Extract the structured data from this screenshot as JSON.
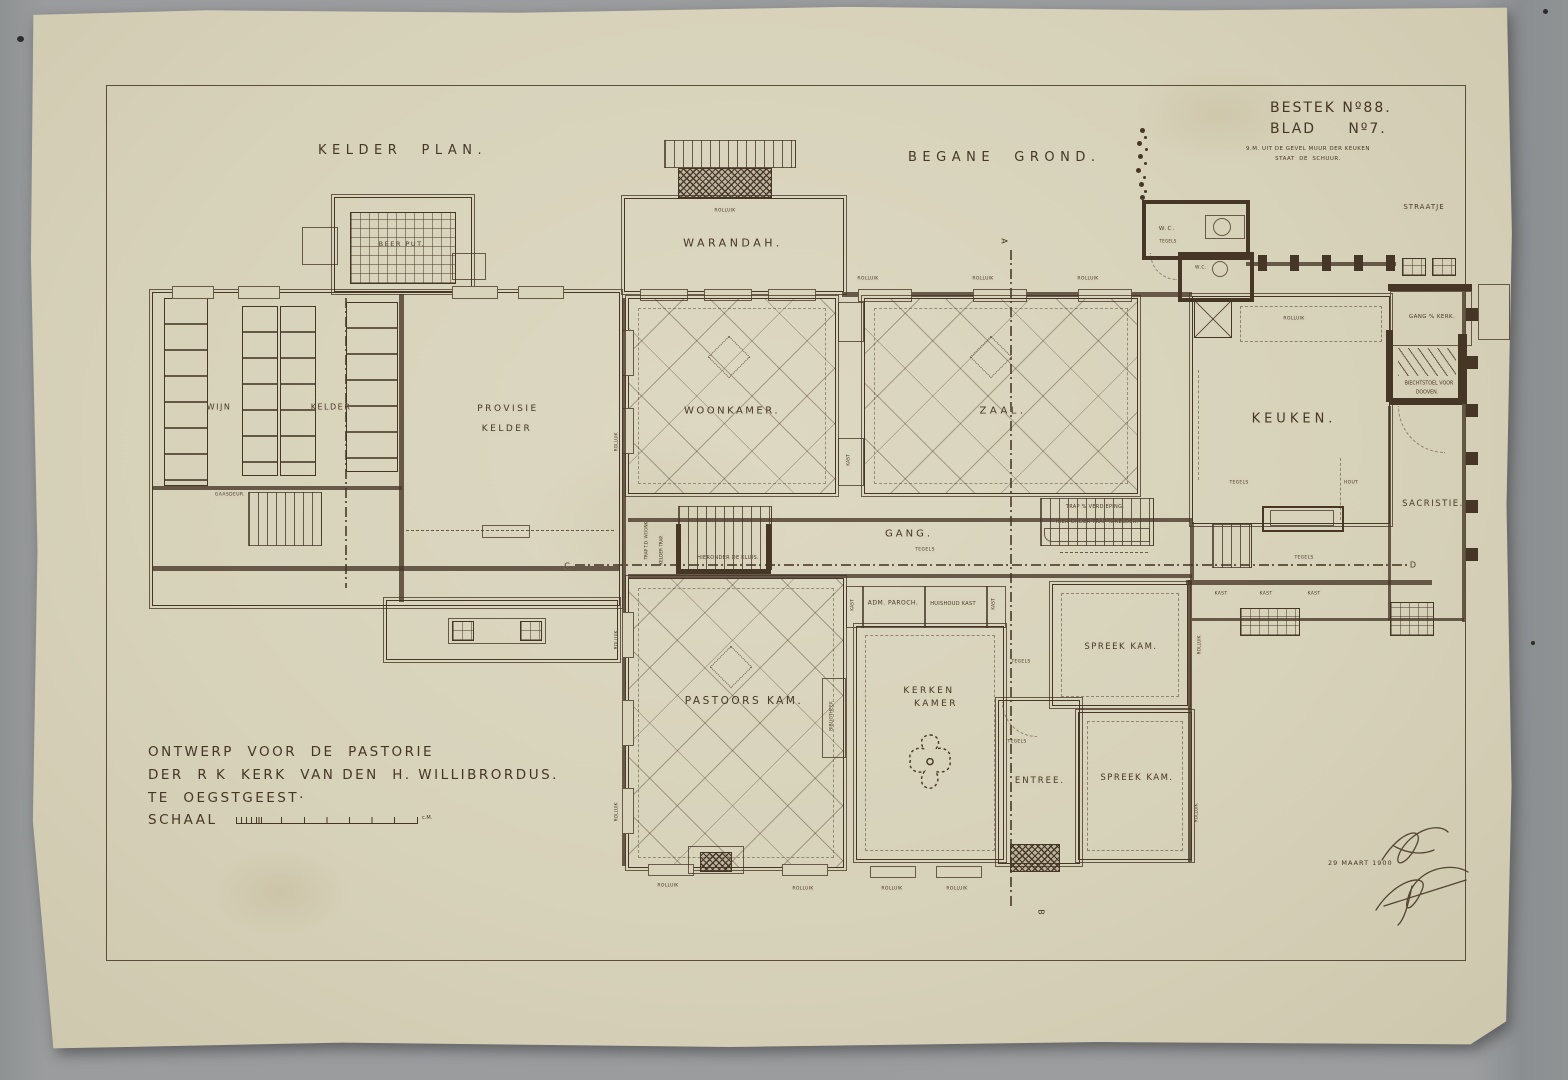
{
  "titles": {
    "kelder_plan": "KELDER  PLAN.",
    "begane_grond": "BEGANE  GROND.",
    "bestek": "BESTEK Nº88.",
    "blad": "BLAD     Nº7.",
    "note1": "9.M. UIT DE GEVEL MUUR DER KEUKEN",
    "note2": "STAAT  DE  SCHUUR."
  },
  "title_block": {
    "line1": "ONTWERP  VOOR  DE  PASTORIE",
    "line2": "DER  R K  KERK  VAN DEN  H. WILLIBRORDUS.",
    "line3": "TE  OEGSTGEEST·",
    "scale_label": "SCHAAL",
    "scale_unit": "c.M.",
    "date": "29 MAART 1900"
  },
  "labels": [
    {
      "t": "BEER PUT.",
      "x": 402,
      "y": 244,
      "fs": 6.5,
      "ls": 1.5,
      "n": "room-label-beerput"
    },
    {
      "t": "WIJN",
      "x": 219,
      "y": 407,
      "fs": 8,
      "ls": 1.5,
      "n": "room-label-wijn"
    },
    {
      "t": "KELDER",
      "x": 331,
      "y": 407,
      "fs": 8,
      "ls": 1.5,
      "n": "room-label-wijnkelder"
    },
    {
      "t": "PROVISIE",
      "x": 508,
      "y": 409,
      "fs": 9,
      "ls": 2.5,
      "n": "room-label-provisie"
    },
    {
      "t": "KELDER",
      "x": 507,
      "y": 429,
      "fs": 9,
      "ls": 2.5,
      "n": "room-label-provisie-kelder"
    },
    {
      "t": "GAASDEUR.",
      "x": 230,
      "y": 495,
      "fs": 4.5,
      "ls": 0.4,
      "n": "annotation"
    },
    {
      "t": "WARANDAH.",
      "x": 733,
      "y": 243,
      "fs": 11,
      "ls": 3.5,
      "n": "room-label-warandah"
    },
    {
      "t": "WOONKAMER.",
      "x": 732,
      "y": 411,
      "fs": 10,
      "ls": 2.5,
      "n": "room-label-woonkamer"
    },
    {
      "t": "ZAAL.",
      "x": 1003,
      "y": 411,
      "fs": 10,
      "ls": 3.5,
      "n": "room-label-zaal"
    },
    {
      "t": "KEUKEN.",
      "x": 1294,
      "y": 419,
      "fs": 13,
      "ls": 4,
      "n": "room-label-keuken"
    },
    {
      "t": "GANG.",
      "x": 909,
      "y": 534,
      "fs": 10,
      "ls": 3,
      "n": "room-label-gang"
    },
    {
      "t": "TEGELS",
      "x": 925,
      "y": 550,
      "fs": 4.5,
      "ls": 0.4,
      "n": "annotation"
    },
    {
      "t": "PASTOORS KAM.",
      "x": 744,
      "y": 701,
      "fs": 10.5,
      "ls": 2.5,
      "n": "room-label-pastoors-kamer"
    },
    {
      "t": "KERKEN",
      "x": 929,
      "y": 691,
      "fs": 9,
      "ls": 2.5,
      "n": "room-label-kerken"
    },
    {
      "t": "KAMER",
      "x": 936,
      "y": 704,
      "fs": 9,
      "ls": 2.5,
      "n": "room-label-kerken-kamer"
    },
    {
      "t": "SPREEK KAM.",
      "x": 1121,
      "y": 647,
      "fs": 8.5,
      "ls": 1.5,
      "n": "room-label-spreekkamer-1"
    },
    {
      "t": "SPREEK KAM.",
      "x": 1137,
      "y": 778,
      "fs": 8.5,
      "ls": 1.5,
      "n": "room-label-spreekkamer-2"
    },
    {
      "t": "ENTREE.",
      "x": 1040,
      "y": 781,
      "fs": 8.5,
      "ls": 2,
      "n": "room-label-entree"
    },
    {
      "t": "SACRISTIE.",
      "x": 1433,
      "y": 504,
      "fs": 8.5,
      "ls": 1.5,
      "n": "room-label-sacristie"
    },
    {
      "t": "STRAATJE",
      "x": 1424,
      "y": 207,
      "fs": 7,
      "ls": 1,
      "n": "room-label-straatje"
    },
    {
      "t": "GANG % KERK.",
      "x": 1432,
      "y": 317,
      "fs": 5.5,
      "ls": 0.4,
      "n": "room-label-gang-kerk"
    },
    {
      "t": "BIECHTSTOEL VOOR",
      "x": 1429,
      "y": 384,
      "fs": 4.8,
      "ls": 0,
      "n": "room-label-biechtstoel"
    },
    {
      "t": "DOOVEN.",
      "x": 1427,
      "y": 393,
      "fs": 4.8,
      "ls": 0,
      "n": "room-label-dooven"
    },
    {
      "t": "W.C.",
      "x": 1167,
      "y": 229,
      "fs": 5.5,
      "ls": 1,
      "n": "room-label-wc-1"
    },
    {
      "t": "TEGELS",
      "x": 1168,
      "y": 241,
      "fs": 4,
      "ls": 0.3,
      "n": "annotation"
    },
    {
      "t": "W.C.",
      "x": 1201,
      "y": 268,
      "fs": 4.5,
      "ls": 0.5,
      "n": "room-label-wc-2"
    },
    {
      "t": "ADM. PAROCH.",
      "x": 893,
      "y": 603,
      "fs": 6,
      "ls": 0.5,
      "n": "cabinet-label"
    },
    {
      "t": "HUISHOUD KAST",
      "x": 953,
      "y": 604,
      "fs": 5,
      "ls": 0.3,
      "n": "cabinet-label"
    },
    {
      "t": "KAST",
      "x": 853,
      "y": 605,
      "fs": 4.5,
      "v": true,
      "n": "cabinet-label"
    },
    {
      "t": "KAST",
      "x": 994,
      "y": 604,
      "fs": 4.5,
      "v": true,
      "n": "cabinet-label"
    },
    {
      "t": "KAST",
      "x": 849,
      "y": 460,
      "fs": 4.5,
      "v": true,
      "n": "cabinet-label"
    },
    {
      "t": "BIBLIOTHEEK",
      "x": 832,
      "y": 716,
      "fs": 4.5,
      "v": true,
      "n": "cabinet-label"
    },
    {
      "t": "TRAP % VERDIEPING.",
      "x": 1095,
      "y": 507,
      "fs": 5,
      "ls": 0.3,
      "n": "stairs-label"
    },
    {
      "t": "HIER ONDER TRAP % KELDER.",
      "x": 1097,
      "y": 522,
      "fs": 5,
      "ls": 0.3,
      "n": "stairs-label"
    },
    {
      "t": "HIERONDER DE KLUIS.",
      "x": 728,
      "y": 558,
      "fs": 5,
      "ls": 0.3,
      "n": "stairs-label"
    },
    {
      "t": "TRAP T.D. WOONK.",
      "x": 646,
      "y": 540,
      "fs": 4.2,
      "v": true,
      "n": "stairs-label"
    },
    {
      "t": "KELDER TRAP.",
      "x": 661,
      "y": 550,
      "fs": 4.2,
      "v": true,
      "n": "stairs-label"
    },
    {
      "t": "ROLLUIK",
      "x": 725,
      "y": 211,
      "fs": 4.5,
      "ls": 0.3,
      "n": "annotation"
    },
    {
      "t": "ROLLUIK",
      "x": 868,
      "y": 279,
      "fs": 4.5,
      "ls": 0.3,
      "n": "annotation"
    },
    {
      "t": "ROLLUIK",
      "x": 983,
      "y": 279,
      "fs": 4.5,
      "ls": 0.3,
      "n": "annotation"
    },
    {
      "t": "ROLLUIK",
      "x": 1088,
      "y": 279,
      "fs": 4.5,
      "ls": 0.3,
      "n": "annotation"
    },
    {
      "t": "ROLLUIK",
      "x": 1294,
      "y": 319,
      "fs": 4.5,
      "ls": 0.3,
      "n": "annotation"
    },
    {
      "t": "ROLLUIK",
      "x": 617,
      "y": 442,
      "fs": 4.5,
      "v": true,
      "n": "annotation"
    },
    {
      "t": "ROLLUIK",
      "x": 617,
      "y": 640,
      "fs": 4.5,
      "v": true,
      "n": "annotation"
    },
    {
      "t": "ROLLUIK",
      "x": 617,
      "y": 812,
      "fs": 4.5,
      "v": true,
      "n": "annotation"
    },
    {
      "t": "ROLLUIK",
      "x": 1200,
      "y": 645,
      "fs": 4.5,
      "v": true,
      "n": "annotation"
    },
    {
      "t": "ROLLUIK",
      "x": 1197,
      "y": 813,
      "fs": 4.5,
      "v": true,
      "n": "annotation"
    },
    {
      "t": "ROLLUIK",
      "x": 668,
      "y": 886,
      "fs": 4.5,
      "ls": 0.3,
      "n": "annotation"
    },
    {
      "t": "ROLLUIK",
      "x": 803,
      "y": 889,
      "fs": 4.5,
      "ls": 0.3,
      "n": "annotation"
    },
    {
      "t": "ROLLUIK",
      "x": 892,
      "y": 889,
      "fs": 4.5,
      "ls": 0.3,
      "n": "annotation"
    },
    {
      "t": "ROLLUIK",
      "x": 957,
      "y": 889,
      "fs": 4.5,
      "ls": 0.3,
      "n": "annotation"
    },
    {
      "t": "TEGELS",
      "x": 1021,
      "y": 662,
      "fs": 4.5,
      "ls": 0.3,
      "n": "annotation"
    },
    {
      "t": "TEGELS",
      "x": 1017,
      "y": 742,
      "fs": 4.5,
      "ls": 0.3,
      "n": "annotation"
    },
    {
      "t": "TEGELS",
      "x": 1239,
      "y": 483,
      "fs": 4.5,
      "ls": 0.3,
      "n": "annotation"
    },
    {
      "t": "TEGELS",
      "x": 1304,
      "y": 558,
      "fs": 4.5,
      "ls": 0.3,
      "n": "annotation"
    },
    {
      "t": "HOUT",
      "x": 1351,
      "y": 483,
      "fs": 4.5,
      "ls": 0.3,
      "n": "annotation"
    },
    {
      "t": "KAST",
      "x": 1221,
      "y": 594,
      "fs": 4.5,
      "ls": 0.3,
      "n": "cabinet-label"
    },
    {
      "t": "KAST",
      "x": 1266,
      "y": 594,
      "fs": 4.5,
      "ls": 0.3,
      "n": "cabinet-label"
    },
    {
      "t": "KAST",
      "x": 1314,
      "y": 594,
      "fs": 4.5,
      "ls": 0.3,
      "n": "cabinet-label"
    },
    {
      "t": "C",
      "x": 567,
      "y": 566,
      "fs": 8,
      "n": "section-marker-c"
    },
    {
      "t": "D",
      "x": 1413,
      "y": 565,
      "fs": 8,
      "n": "section-marker-d"
    },
    {
      "t": "A",
      "x": 1004,
      "y": 241,
      "fs": 8,
      "r": 90,
      "n": "section-marker-a"
    },
    {
      "t": "B",
      "x": 1041,
      "y": 912,
      "fs": 8,
      "r": 90,
      "n": "section-marker-b"
    }
  ]
}
